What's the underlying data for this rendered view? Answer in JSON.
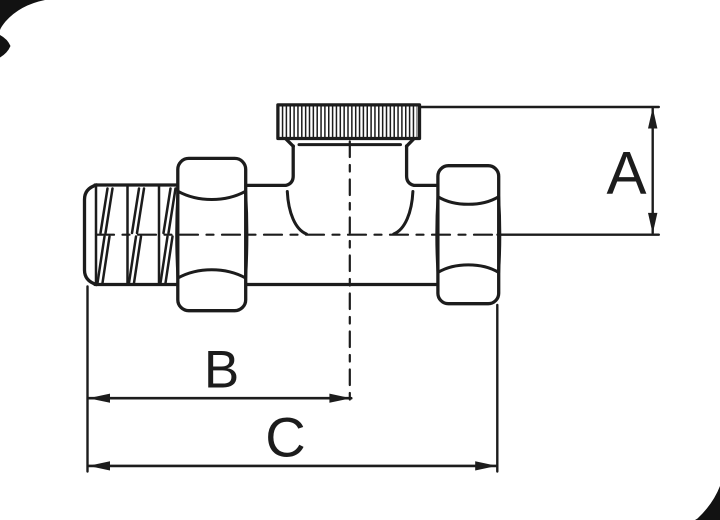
{
  "diagram": {
    "type": "technical-drawing",
    "subject": "straight-radiator-valve-side-view",
    "background_color": "#ffffff",
    "line_color": "#1c1c1c",
    "corner_mark_color": "#121212",
    "labels": {
      "a": "A",
      "b": "B",
      "c": "C"
    }
  }
}
